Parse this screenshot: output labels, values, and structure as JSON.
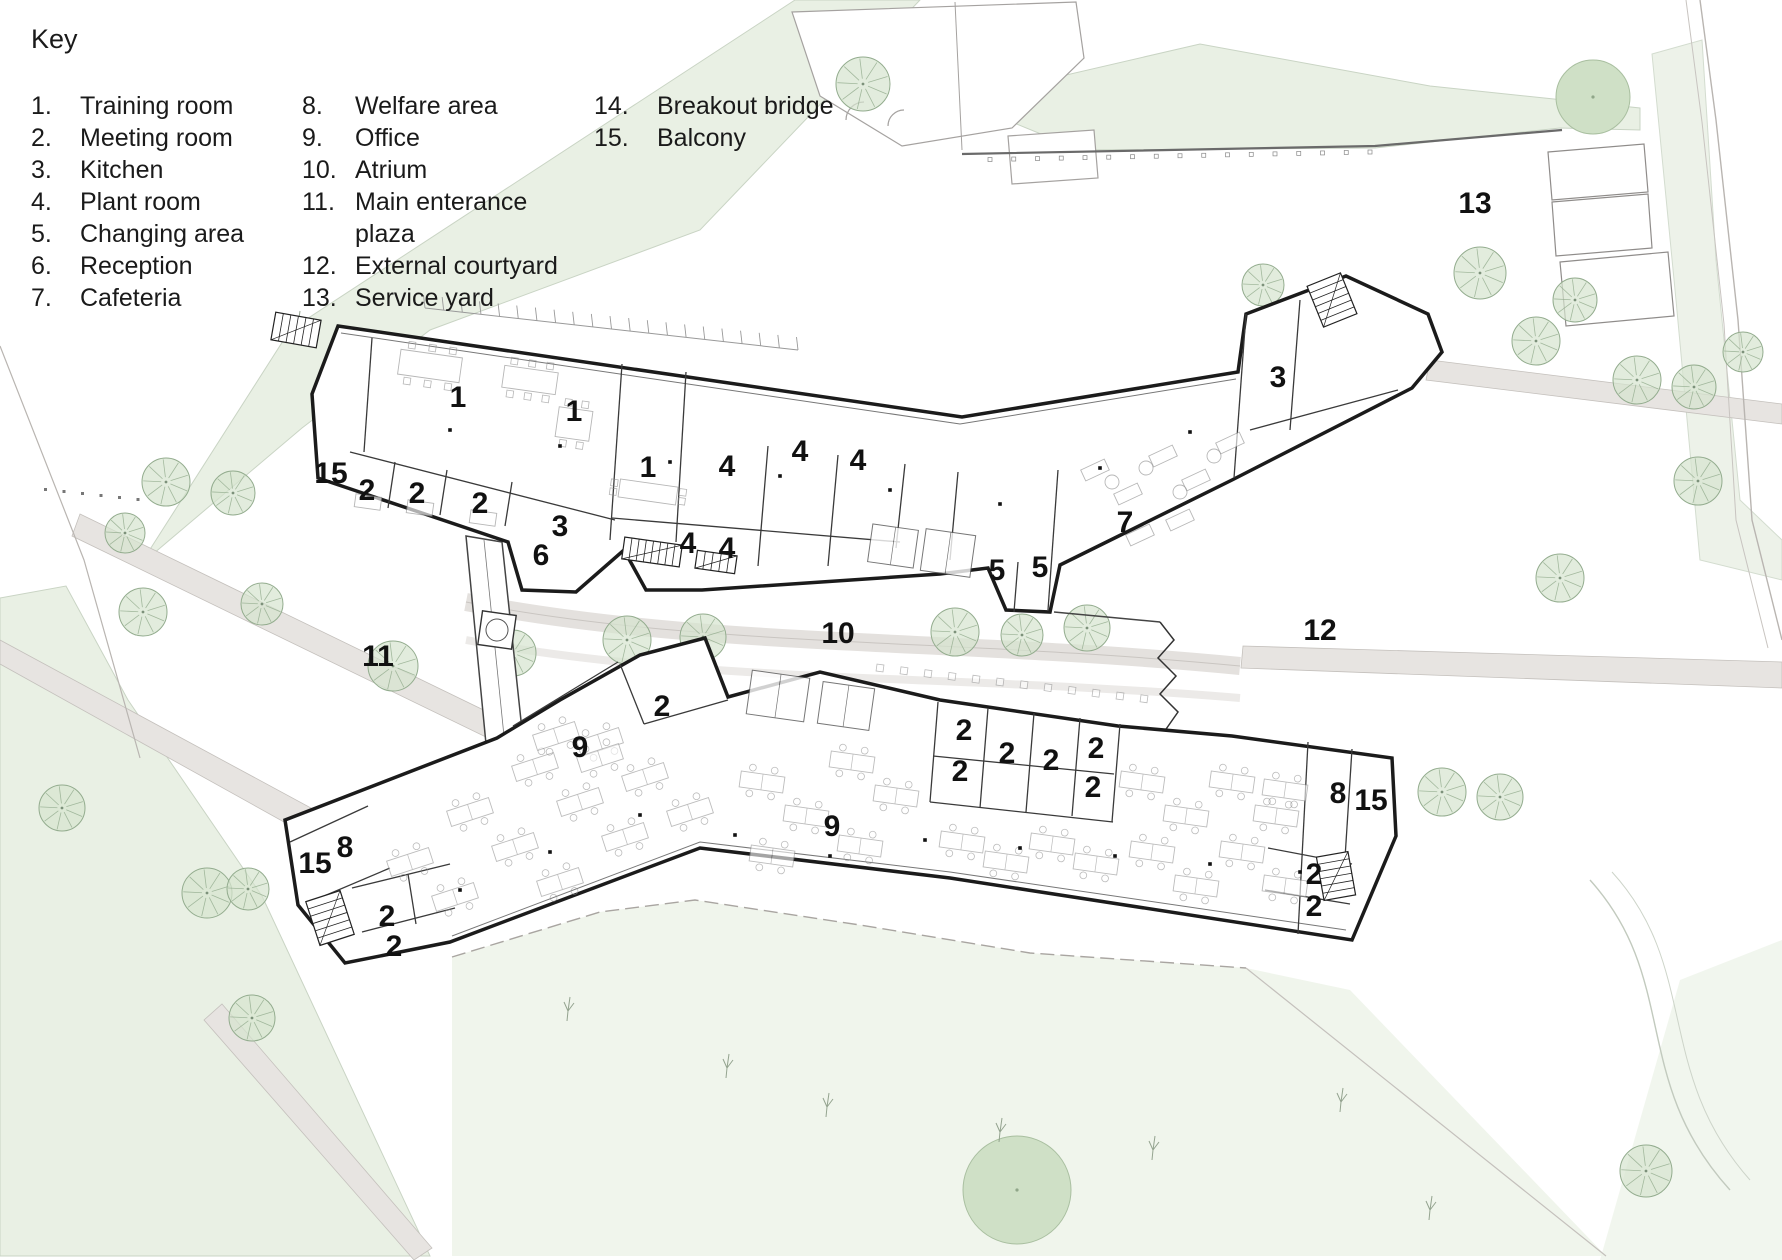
{
  "key": {
    "title": "Key",
    "columns": [
      {
        "items": [
          {
            "num": "1.",
            "label": "Training room"
          },
          {
            "num": "2.",
            "label": "Meeting room"
          },
          {
            "num": "3.",
            "label": "Kitchen"
          },
          {
            "num": "4.",
            "label": "Plant room"
          },
          {
            "num": "5.",
            "label": "Changing area"
          },
          {
            "num": "6.",
            "label": "Reception"
          },
          {
            "num": "7.",
            "label": "Cafeteria"
          }
        ]
      },
      {
        "items": [
          {
            "num": "8.",
            "label": "Welfare area"
          },
          {
            "num": "9.",
            "label": "Office"
          },
          {
            "num": "10.",
            "label": "Atrium"
          },
          {
            "num": "11.",
            "label": "Main enterance plaza"
          },
          {
            "num": "12.",
            "label": "External courtyard"
          },
          {
            "num": "13.",
            "label": "Service yard"
          }
        ]
      },
      {
        "items": [
          {
            "num": "14.",
            "label": "Breakout bridge"
          },
          {
            "num": "15.",
            "label": "Balcony"
          }
        ]
      }
    ]
  },
  "plan": {
    "room_labels": [
      {
        "text": "1",
        "x": 458,
        "y": 397
      },
      {
        "text": "1",
        "x": 574,
        "y": 411
      },
      {
        "text": "1",
        "x": 648,
        "y": 467
      },
      {
        "text": "15",
        "x": 331,
        "y": 473
      },
      {
        "text": "2",
        "x": 367,
        "y": 490
      },
      {
        "text": "2",
        "x": 417,
        "y": 493
      },
      {
        "text": "2",
        "x": 480,
        "y": 503
      },
      {
        "text": "3",
        "x": 560,
        "y": 526
      },
      {
        "text": "6",
        "x": 541,
        "y": 555
      },
      {
        "text": "4",
        "x": 727,
        "y": 466
      },
      {
        "text": "4",
        "x": 800,
        "y": 451
      },
      {
        "text": "4",
        "x": 858,
        "y": 460
      },
      {
        "text": "4",
        "x": 688,
        "y": 543
      },
      {
        "text": "4",
        "x": 727,
        "y": 548
      },
      {
        "text": "5",
        "x": 997,
        "y": 570
      },
      {
        "text": "5",
        "x": 1040,
        "y": 567
      },
      {
        "text": "7",
        "x": 1125,
        "y": 522
      },
      {
        "text": "3",
        "x": 1278,
        "y": 377
      },
      {
        "text": "2",
        "x": 662,
        "y": 706
      },
      {
        "text": "9",
        "x": 580,
        "y": 747
      },
      {
        "text": "9",
        "x": 832,
        "y": 826
      },
      {
        "text": "2",
        "x": 964,
        "y": 730
      },
      {
        "text": "2",
        "x": 960,
        "y": 771
      },
      {
        "text": "2",
        "x": 1007,
        "y": 753
      },
      {
        "text": "2",
        "x": 1051,
        "y": 760
      },
      {
        "text": "2",
        "x": 1096,
        "y": 748
      },
      {
        "text": "2",
        "x": 1093,
        "y": 787
      },
      {
        "text": "8",
        "x": 345,
        "y": 847
      },
      {
        "text": "15",
        "x": 315,
        "y": 863
      },
      {
        "text": "2",
        "x": 387,
        "y": 916
      },
      {
        "text": "2",
        "x": 394,
        "y": 946
      },
      {
        "text": "8",
        "x": 1338,
        "y": 793
      },
      {
        "text": "15",
        "x": 1371,
        "y": 800
      },
      {
        "text": "2",
        "x": 1314,
        "y": 874
      },
      {
        "text": "2",
        "x": 1314,
        "y": 906
      },
      {
        "text": "10",
        "x": 838,
        "y": 633
      },
      {
        "text": "11",
        "x": 378,
        "y": 656
      },
      {
        "text": "12",
        "x": 1320,
        "y": 630
      },
      {
        "text": "13",
        "x": 1475,
        "y": 203
      }
    ],
    "trees_outlined": [
      {
        "x": 166,
        "y": 482,
        "r": 24
      },
      {
        "x": 233,
        "y": 493,
        "r": 22
      },
      {
        "x": 143,
        "y": 612,
        "r": 24
      },
      {
        "x": 262,
        "y": 604,
        "r": 21
      },
      {
        "x": 393,
        "y": 666,
        "r": 25
      },
      {
        "x": 513,
        "y": 653,
        "r": 23
      },
      {
        "x": 125,
        "y": 533,
        "r": 20
      },
      {
        "x": 62,
        "y": 808,
        "r": 23
      },
      {
        "x": 207,
        "y": 893,
        "r": 25
      },
      {
        "x": 248,
        "y": 889,
        "r": 21
      },
      {
        "x": 252,
        "y": 1018,
        "r": 23
      },
      {
        "x": 863,
        "y": 84,
        "r": 27
      },
      {
        "x": 1263,
        "y": 285,
        "r": 21
      },
      {
        "x": 1313,
        "y": 322,
        "r": 19
      },
      {
        "x": 1480,
        "y": 273,
        "r": 26
      },
      {
        "x": 1536,
        "y": 341,
        "r": 24
      },
      {
        "x": 1575,
        "y": 300,
        "r": 22
      },
      {
        "x": 1637,
        "y": 380,
        "r": 24
      },
      {
        "x": 1694,
        "y": 387,
        "r": 22
      },
      {
        "x": 1743,
        "y": 352,
        "r": 20
      },
      {
        "x": 1698,
        "y": 481,
        "r": 24
      },
      {
        "x": 1560,
        "y": 578,
        "r": 24
      },
      {
        "x": 1442,
        "y": 792,
        "r": 24
      },
      {
        "x": 1500,
        "y": 797,
        "r": 23
      },
      {
        "x": 1646,
        "y": 1171,
        "r": 26
      },
      {
        "x": 627,
        "y": 640,
        "r": 24
      },
      {
        "x": 703,
        "y": 637,
        "r": 23
      },
      {
        "x": 955,
        "y": 632,
        "r": 24
      },
      {
        "x": 1022,
        "y": 635,
        "r": 21
      },
      {
        "x": 1087,
        "y": 628,
        "r": 23
      }
    ],
    "trees_solid": [
      {
        "x": 1593,
        "y": 97,
        "r": 37
      },
      {
        "x": 1017,
        "y": 1190,
        "r": 54
      }
    ]
  },
  "colors": {
    "grass": "#e9f0e4",
    "grass_light": "#f0f5ec",
    "tree_fill": "#d5e4cf",
    "tree_stroke": "#93ac8e",
    "path_fill": "#e7e4e1",
    "path_stroke": "#c4c0bc",
    "wall": "#1b1b1b",
    "partition": "#3a3a3a",
    "furniture": "#909090",
    "label": "#111111"
  }
}
